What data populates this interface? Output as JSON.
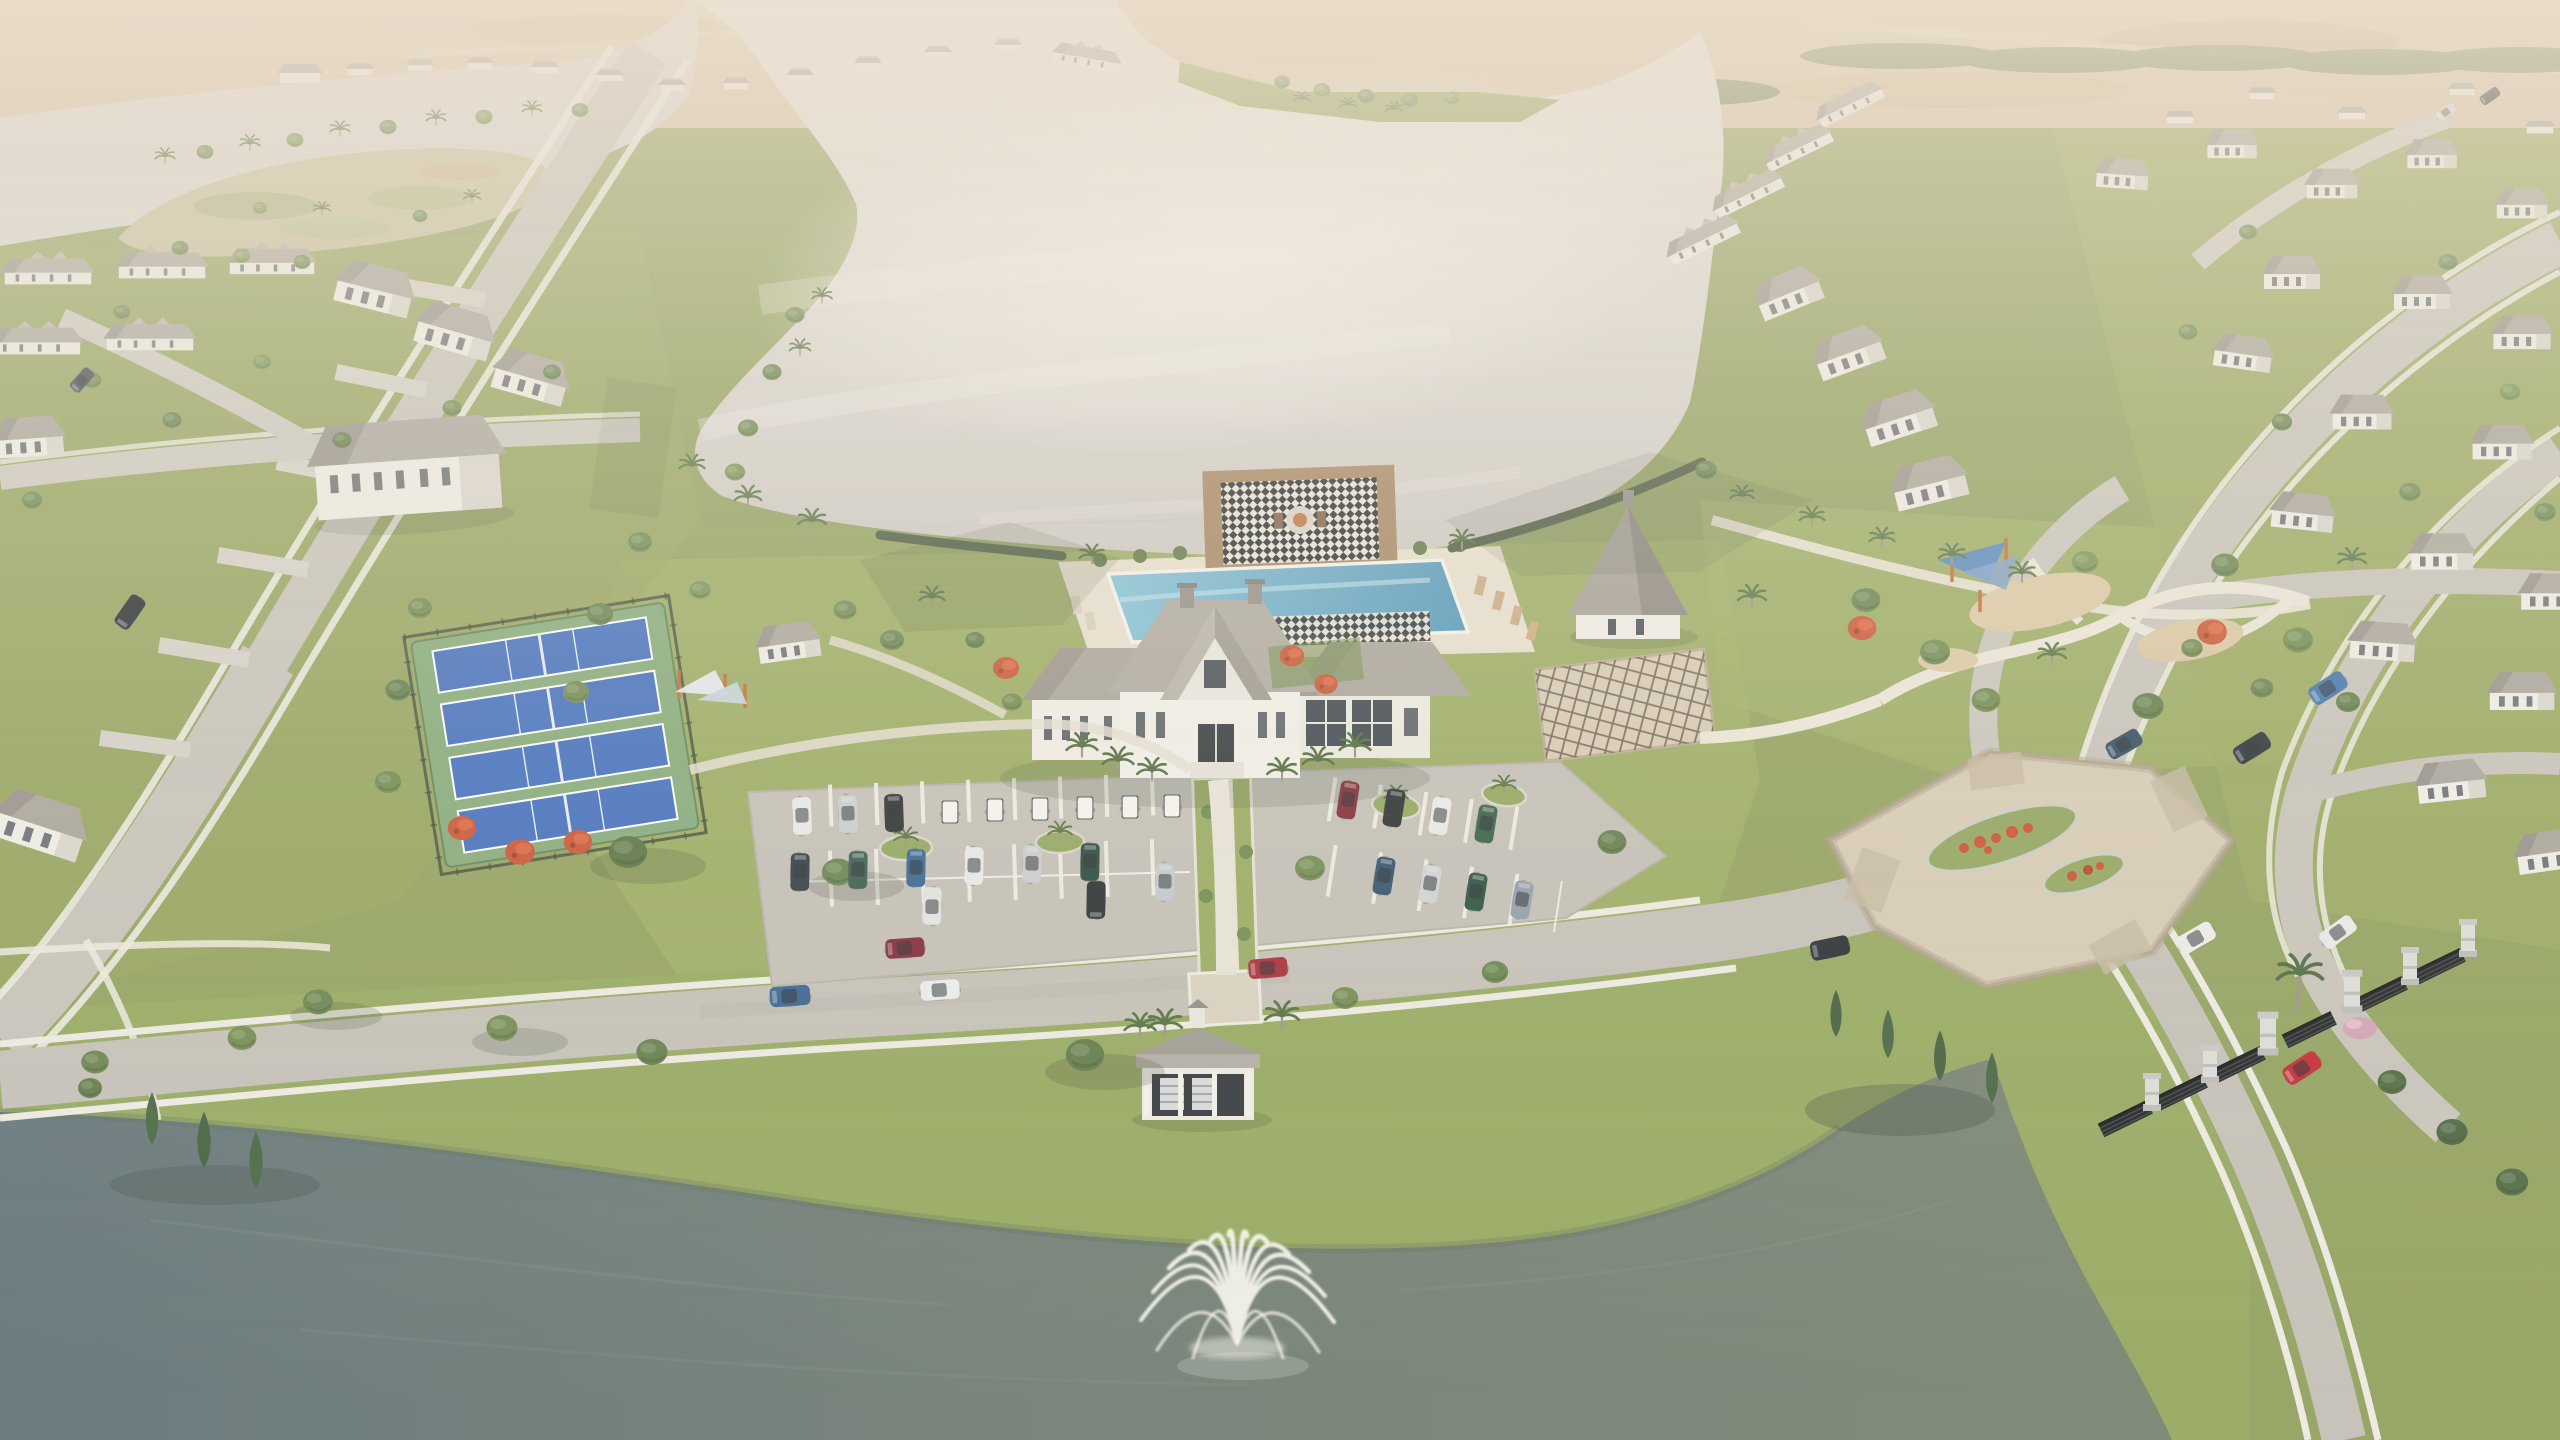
{
  "meta": {
    "title": "Aerial rendering of a master-planned lakefront community",
    "style": "hazy daylight 3D architectural rendering",
    "no_visible_text": true
  },
  "palette": {
    "haze": "#eadfd0",
    "field": "#d5c2a6",
    "treeline": "#62784a",
    "grass": "#8f9f5b",
    "lawn_bright": "#9fb264",
    "lake": "#ded9d4",
    "lake_sheen": "#f0ece8",
    "channel_water": "#d8d4cf",
    "pond_left": "#5e7077",
    "pond_right": "#74806f",
    "road": "#c6c2ba",
    "sidewalk": "#edeae1",
    "paver": "#d6cab4",
    "asphalt": "#c2beb6",
    "roof": "#a8a39b",
    "roof_shade": "#948f87",
    "wall": "#f0ede7",
    "window": "#3e454c",
    "pool_blue": "#5ba5c6",
    "court_blue": "#3e6cbe",
    "court_apron": "#83a877",
    "flower_red": "#c94b2a",
    "sail_blue": "#4f83c2",
    "post_orange": "#c06a32",
    "gate_black": "#17191c",
    "pillar_gray": "#dcdcda",
    "deck_wood": "#a2825f",
    "checker_dark": "#23272b",
    "checker_light": "#e9e4d8",
    "fountain_white": "#f6f4ee"
  },
  "scene": {
    "water": {
      "lake": "Central community lake",
      "channel": "Wetland channel",
      "marsh": "Marsh island",
      "pond": "Foreground pond",
      "fountain": "Pond spray fountain"
    },
    "amenities": {
      "clubhouse": "Lakefront clubhouse",
      "pool": "Resort-style pool",
      "fire_pit_plaza": "Checkerboard fire-pit plaza",
      "pool_deck": "Pool deck with loungers",
      "pergola": "Garden trellis pergola",
      "hall": "Steep-roof amenity hall",
      "playground": "Playground with shade sails",
      "pickleball_label": "Pickleball courts",
      "pickleball_count": 4,
      "court_shade": "Court shade sails",
      "mail_pavilion": "Mail pavilion",
      "parking_label": "Amenity parking lot",
      "parked_cars": 20,
      "golf_carts": 6
    },
    "circulation": {
      "boulevard": "Main boulevard",
      "intersection": "Paver entry intersection with flower medians",
      "gate": "Gated entry with black gates and stone pillars",
      "west_road": "West neighborhood road",
      "east_roads": "East curving neighborhood roads",
      "promenade": "Central paver promenade",
      "cars_on_roads": 15
    },
    "neighborhoods": {
      "west": "West townhome neighborhood",
      "east": "East single-family neighborhood",
      "north": "Far development fields"
    },
    "vegetation": {
      "palms": "Palm trees",
      "oaks": "Shade trees",
      "cypress": "Cypress trees at pond",
      "flowering": "Red flowering trees",
      "pink_bush": "Pink flowering shrub at gate"
    }
  }
}
